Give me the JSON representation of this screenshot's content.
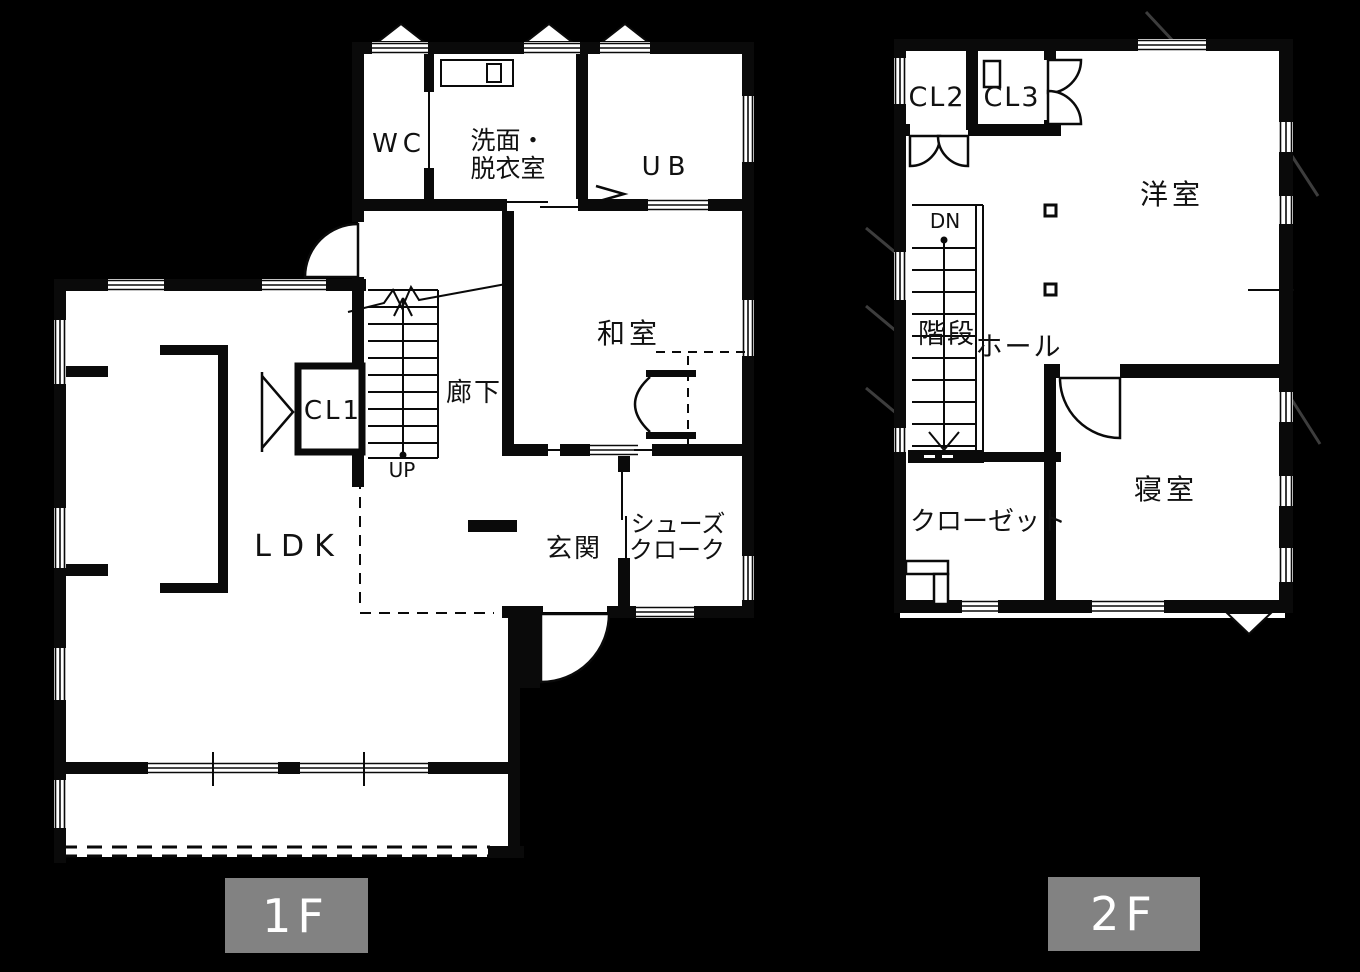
{
  "page": {
    "background": "#000000",
    "floor_color": "#ffffff",
    "wall_color": "#0a0a0a"
  },
  "colors": {
    "badge_background": "#828282",
    "badge_text": "#ffffff"
  },
  "floor1": {
    "badge_label": "1F",
    "rooms": {
      "wc": "WC",
      "washroom_line1": "洗面・",
      "washroom_line2": "脱衣室",
      "unit_bath": "UB",
      "japanese_room": "和室",
      "corridor": "廊下",
      "closet1": "CL1",
      "ldk": "LDK",
      "entrance": "玄関",
      "shoe_cloak_line1": "シューズ",
      "shoe_cloak_line2": "クローク",
      "stair_direction": "UP"
    }
  },
  "floor2": {
    "badge_label": "2F",
    "rooms": {
      "closet2": "CL2",
      "closet3": "CL3",
      "western_room": "洋室",
      "staircase": "階段",
      "hall": "ホール",
      "bedroom": "寝室",
      "walk_in_closet": "クローゼット",
      "stair_direction": "DN"
    }
  }
}
